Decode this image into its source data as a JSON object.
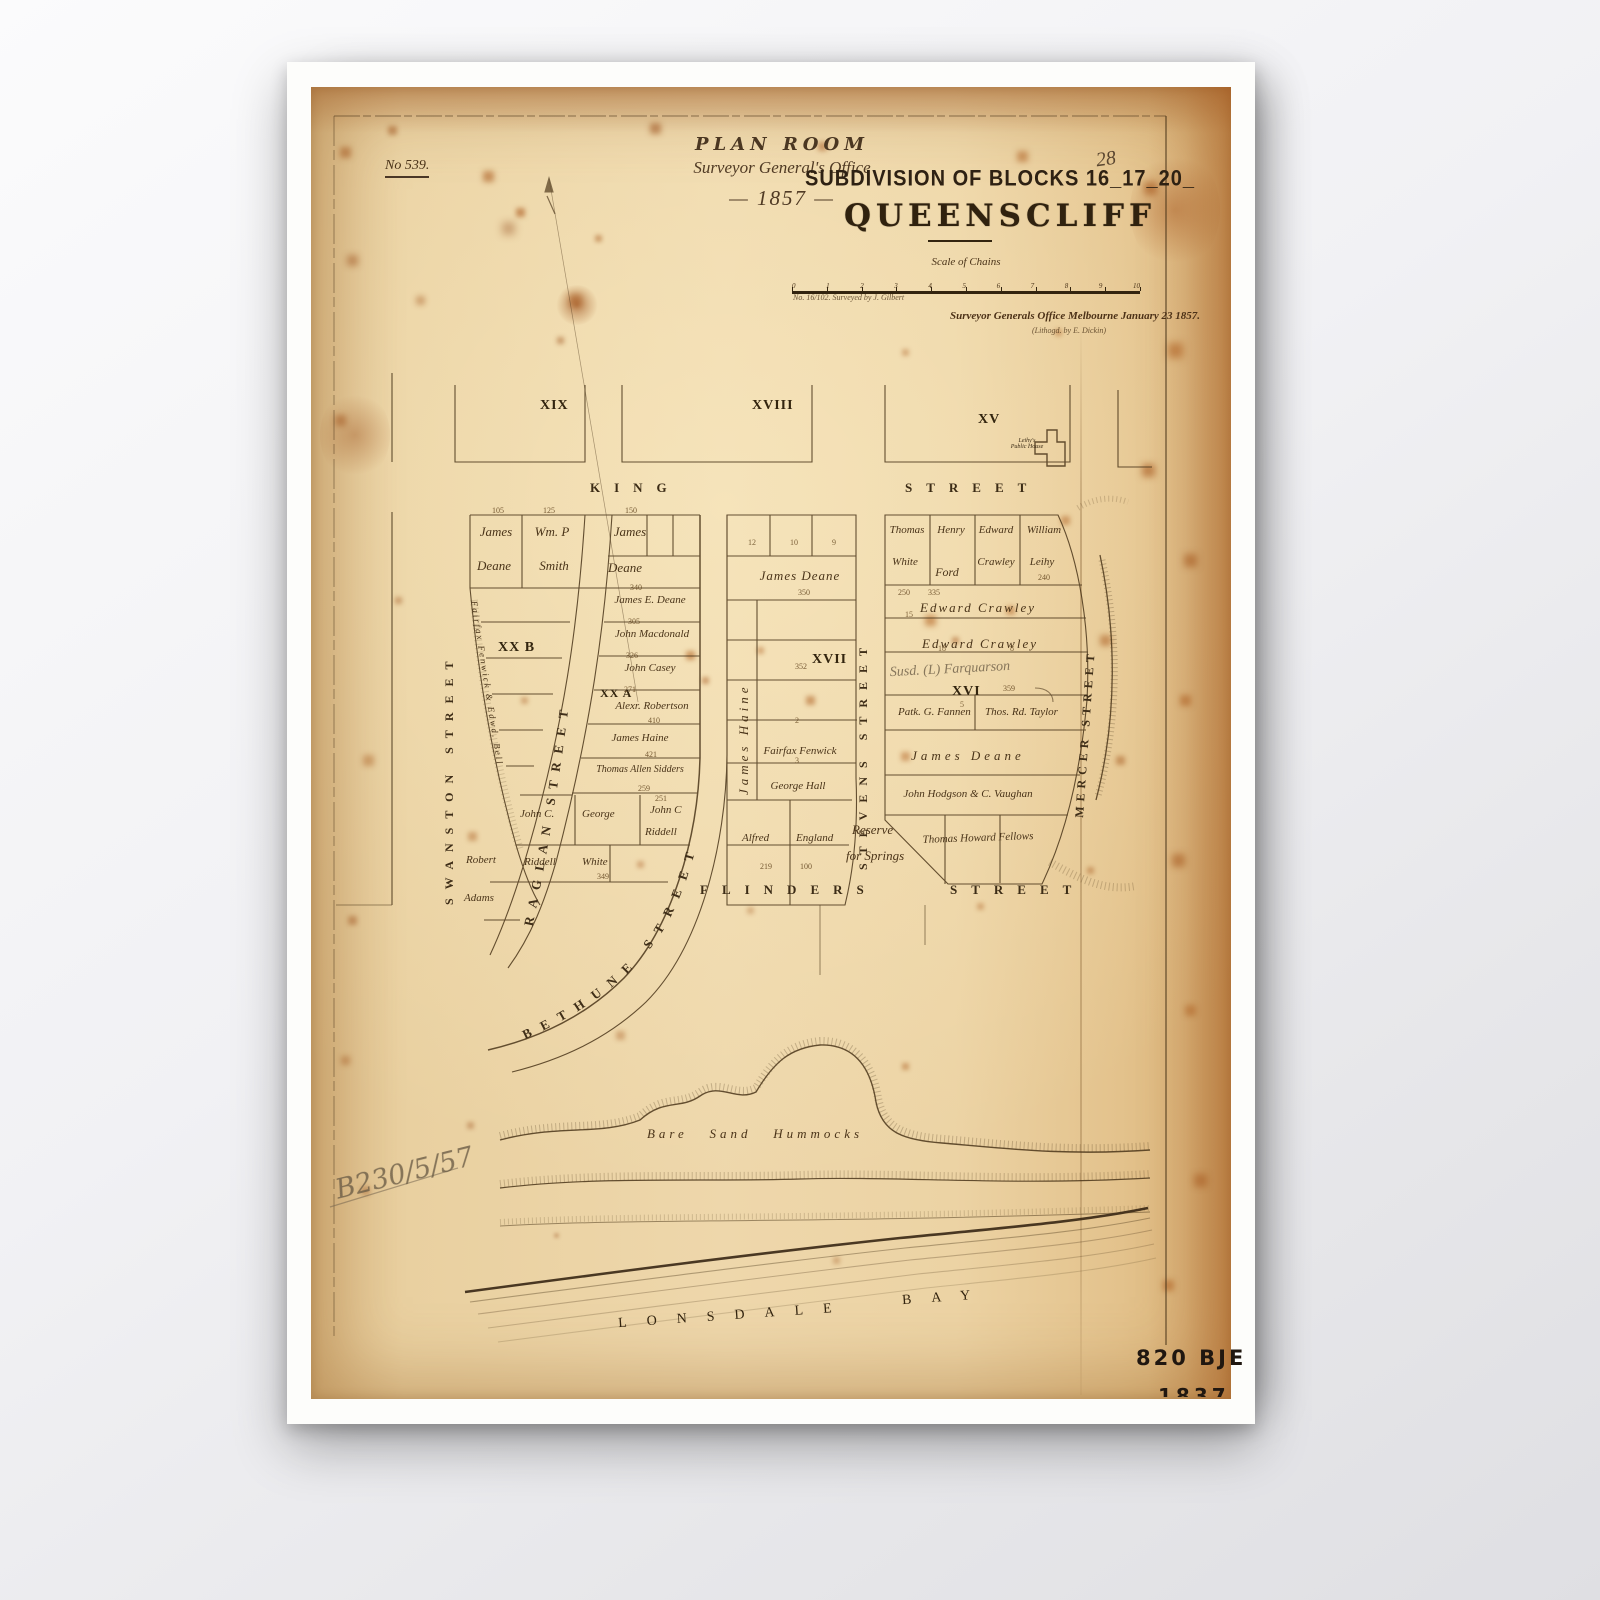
{
  "header": {
    "plan_no": "No 539.",
    "page_no": "28",
    "stamp_line1": "PLAN ROOM",
    "stamp_line2": "Surveyor General's Office",
    "stamp_year": "— 1857 —"
  },
  "title": {
    "subdivision": "SUBDIVISION OF BLOCKS 16_17_20_",
    "name": "QUEENSCLIFF"
  },
  "scale": {
    "label": "Scale of Chains",
    "ticks": [
      "0",
      "1",
      "2",
      "3",
      "4",
      "5",
      "6",
      "7",
      "8",
      "9",
      "10"
    ],
    "surveyed_note": "No. 16/102. Surveyed by J. Gilbert",
    "office_note": "Surveyor Generals Office Melbourne January 23 1857.",
    "litho_note": "(Lithogd. by E. Dickin)"
  },
  "top_blocks": {
    "b1": "XIX",
    "b2": "XVIII",
    "b3": "XV",
    "public_house_l1": "Leihy's",
    "public_house_l2": "Public House"
  },
  "streets": {
    "king": "KING",
    "king2": "STREET",
    "flinders": "FLINDERS",
    "flinders2": "STREET",
    "swanston": "SWANSTON STREET",
    "raglan": "RAGLAN STREET",
    "bethune": "BETHUNE STREET",
    "stevens": "STEVENS STREET",
    "mercer": "MERCER STREET"
  },
  "blocks": {
    "xxb": "XX B",
    "xxa": "XX A",
    "xvii": "XVII",
    "xvi": "XVI",
    "left": {
      "lot1a": "James",
      "lot1a2": "Deane",
      "lot1b": "Wm. P",
      "lot1b2": "Smith",
      "curve_owner": "Fairfax Fenwick & Edwd. Bell",
      "r1": "James",
      "r1b": "Deane",
      "r2": "James E. Deane",
      "r3": "John Macdonald",
      "r4": "John Casey",
      "r5": "Alexr. Robertson",
      "r6": "James Haine",
      "r7": "Thomas Allen Sidders",
      "r8a": "John C.",
      "r8b": "George",
      "r8c": "John C",
      "r8c2": "Riddell",
      "r9a": "Robert",
      "r9b": "Riddell",
      "r9c": "White",
      "r10": "Adams"
    },
    "middle": {
      "top": "James Deane",
      "side": "James Haine",
      "r1": "Fairfax Fenwick",
      "r2": "George Hall",
      "r3a": "Alfred",
      "r3b": "England"
    },
    "right": {
      "c1": "Thomas",
      "c1b": "White",
      "c2": "Henry",
      "c2b": "Ford",
      "c3": "Edward",
      "c3b": "Crawley",
      "c4": "William",
      "c4b": "Leihy",
      "r1": "Edward Crawley",
      "r2": "Edward Crawley",
      "pencil": "Susd. (L) Farquarson",
      "r3a": "Patk. G. Fannen",
      "r3b": "Thos. Rd. Taylor",
      "r4": "James Deane",
      "r5": "John Hodgson & C. Vaughan",
      "r6": "Thomas Howard Fellows"
    },
    "reserve1": "Reserve",
    "reserve2": "for Springs"
  },
  "shore": {
    "dunes": "Bare   Sand   Hummocks",
    "bay1": "LONSDALE",
    "bay2": "BAY"
  },
  "marks": {
    "pencil": "B230/5/57",
    "stamp_code": "820 BJE",
    "stamp_year_partial": "1837"
  },
  "dimensions": [
    "105",
    "125",
    "150",
    "340",
    "305",
    "326",
    "271",
    "410",
    "421",
    "259",
    "251",
    "349",
    "219",
    "100",
    "350",
    "352",
    "335",
    "359",
    "250",
    "240"
  ],
  "lot_numbers": [
    "12",
    "10",
    "9",
    "15",
    "18",
    "8",
    "5",
    "2",
    "3"
  ],
  "colors": {
    "paper": "#e8cfa0",
    "ink": "#3b2a16",
    "rust": "#a6521c",
    "pencil": "#6c5c46"
  }
}
